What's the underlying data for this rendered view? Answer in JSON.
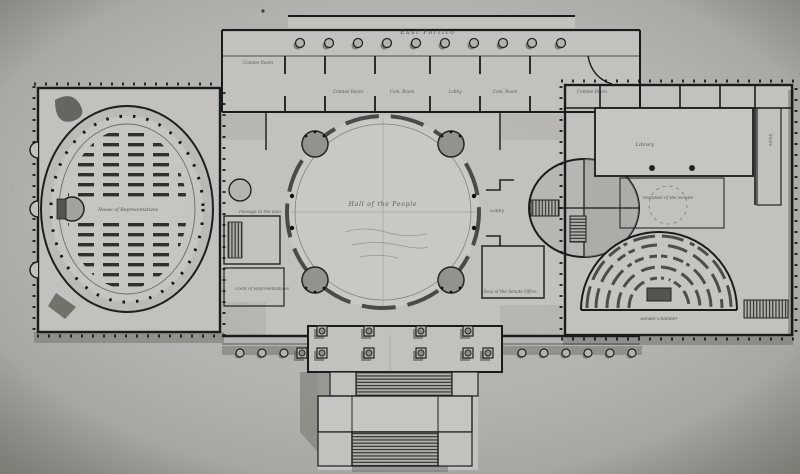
{
  "drawing": {
    "labels": {
      "north_portico": "East Portico",
      "rotunda": "Hall of the People",
      "house_chamber": "House of Representatives",
      "senate_chamber": "Senate Chamber",
      "library": "Library",
      "senate_vestibule": "Vestibule of the Senate",
      "lobby": "Lobby",
      "passage": "Passage to the Hall",
      "clerk_office": "Clerk of Representatives",
      "senate_office": "Secy of the Senate Office",
      "stairs_vertical": "Stairs",
      "committee_rooms": [
        {
          "label": "Comtee Room"
        },
        {
          "label": "Comtee Room"
        },
        {
          "label": "Com. Room"
        },
        {
          "label": "Lobby"
        },
        {
          "label": "Com. Room"
        },
        {
          "label": "Comtee Room"
        }
      ]
    },
    "colors": {
      "paper": "#b3b2ae",
      "building_wash": "#c2c1bd",
      "rotunda_fill": "#c9c8c4",
      "ink": "#1b1b1b",
      "shadow_wash": "#6f6e68",
      "label_ink": "#3b3b41"
    }
  }
}
